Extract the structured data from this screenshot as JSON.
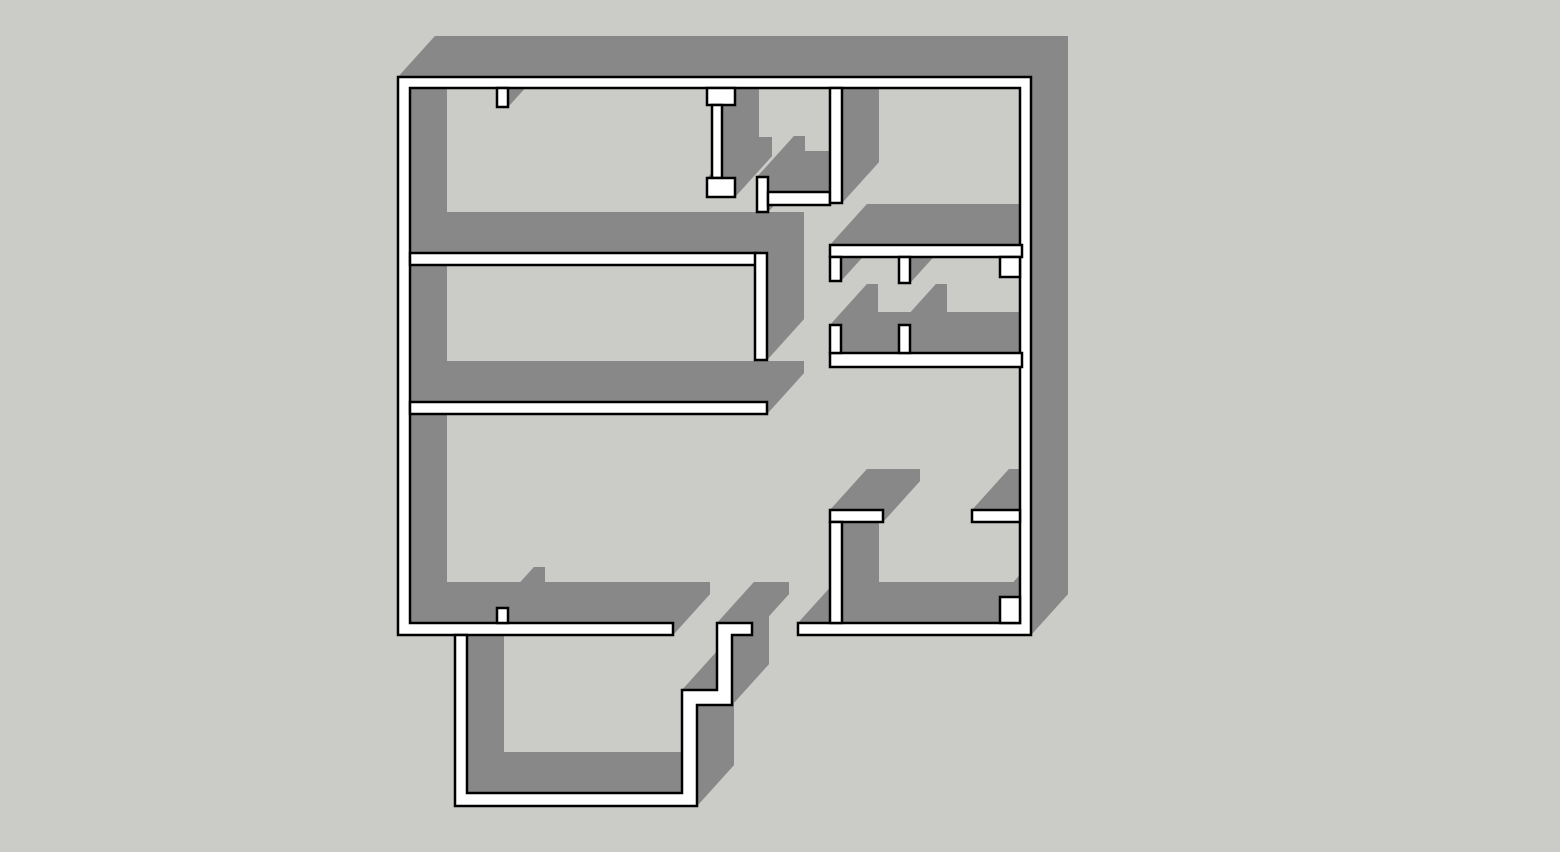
{
  "scene": {
    "title": "3D extruded floor plan",
    "description": "Monochrome SketchUp-style axonometric rendering of an apartment floor plan with extruded white walls casting gray side faces on a plain gray background. No text, toolbars or UI chrome are visible.",
    "view": "top-down axonometric"
  },
  "canvas": {
    "width": 1560,
    "height": 852
  },
  "colors": {
    "background": "#CBCBC7",
    "floor": "#CBCBC7",
    "wall_top": "#FFFFFF",
    "wall_side": "#888888",
    "outline": "#000000",
    "outline_width": 2.5
  },
  "projection": {
    "extrusion_dx": 37,
    "extrusion_dy": -41
  },
  "walls": [
    {
      "name": "outer-wall",
      "points": [
        [
          398,
          77
        ],
        [
          1031,
          77
        ],
        [
          1031,
          635
        ],
        [
          798,
          635
        ],
        [
          798,
          623
        ],
        [
          1020,
          623
        ],
        [
          1020,
          88
        ],
        [
          410,
          88
        ],
        [
          410,
          623
        ],
        [
          673,
          623
        ],
        [
          673,
          635
        ],
        [
          398,
          635
        ]
      ]
    },
    {
      "name": "balcony-wall",
      "points": [
        [
          455,
          635
        ],
        [
          455,
          806
        ],
        [
          697,
          806
        ],
        [
          697,
          705
        ],
        [
          732,
          705
        ],
        [
          732,
          635
        ],
        [
          752,
          635
        ],
        [
          752,
          623
        ],
        [
          717,
          623
        ],
        [
          717,
          690
        ],
        [
          682,
          690
        ],
        [
          682,
          793
        ],
        [
          467,
          793
        ],
        [
          467,
          635
        ]
      ]
    },
    {
      "name": "room2-north-wall",
      "rect": [
        410,
        253,
        347,
        12
      ]
    },
    {
      "name": "hall-west-wall",
      "rect": [
        755,
        253,
        12,
        107
      ]
    },
    {
      "name": "room2-south-wall",
      "rect": [
        410,
        402,
        357,
        12
      ]
    },
    {
      "name": "room3-door-stop",
      "rect": [
        497,
        608,
        11,
        15
      ]
    },
    {
      "name": "room1-door-stop",
      "rect": [
        497,
        88,
        11,
        19
      ]
    },
    {
      "name": "room1-east-wall-cap-top",
      "rect": [
        707,
        88,
        28,
        17
      ]
    },
    {
      "name": "room1-east-wall",
      "rect": [
        712,
        105,
        10,
        73
      ]
    },
    {
      "name": "room1-east-wall-cap-bottom",
      "rect": [
        707,
        178,
        28,
        19
      ]
    },
    {
      "name": "closet-door-post",
      "rect": [
        757,
        177,
        11,
        35
      ]
    },
    {
      "name": "closet-south-wall",
      "rect": [
        768,
        192,
        62,
        13
      ]
    },
    {
      "name": "closet-east-wall",
      "rect": [
        830,
        88,
        12,
        115
      ]
    },
    {
      "name": "bath-north-wall",
      "rect": [
        830,
        245,
        192,
        12
      ]
    },
    {
      "name": "bath-west-stub",
      "rect": [
        830,
        257,
        11,
        24
      ]
    },
    {
      "name": "bath-mid-stub",
      "rect": [
        899,
        257,
        11,
        26
      ]
    },
    {
      "name": "bath-ne-pilaster",
      "rect": [
        1000,
        257,
        20,
        20
      ]
    },
    {
      "name": "bath-south-wall",
      "rect": [
        830,
        353,
        192,
        14
      ]
    },
    {
      "name": "bath-west-wall-lower",
      "rect": [
        830,
        325,
        11,
        28
      ]
    },
    {
      "name": "bath-divider-wall",
      "rect": [
        899,
        325,
        11,
        28
      ]
    },
    {
      "name": "bedroom-north-wall-west",
      "rect": [
        830,
        510,
        53,
        12
      ]
    },
    {
      "name": "bedroom-west-wall",
      "rect": [
        830,
        522,
        12,
        101
      ]
    },
    {
      "name": "bedroom-north-wall-east",
      "rect": [
        972,
        510,
        48,
        12
      ]
    },
    {
      "name": "bedroom-se-pier",
      "rect": [
        1000,
        597,
        20,
        26
      ]
    }
  ]
}
